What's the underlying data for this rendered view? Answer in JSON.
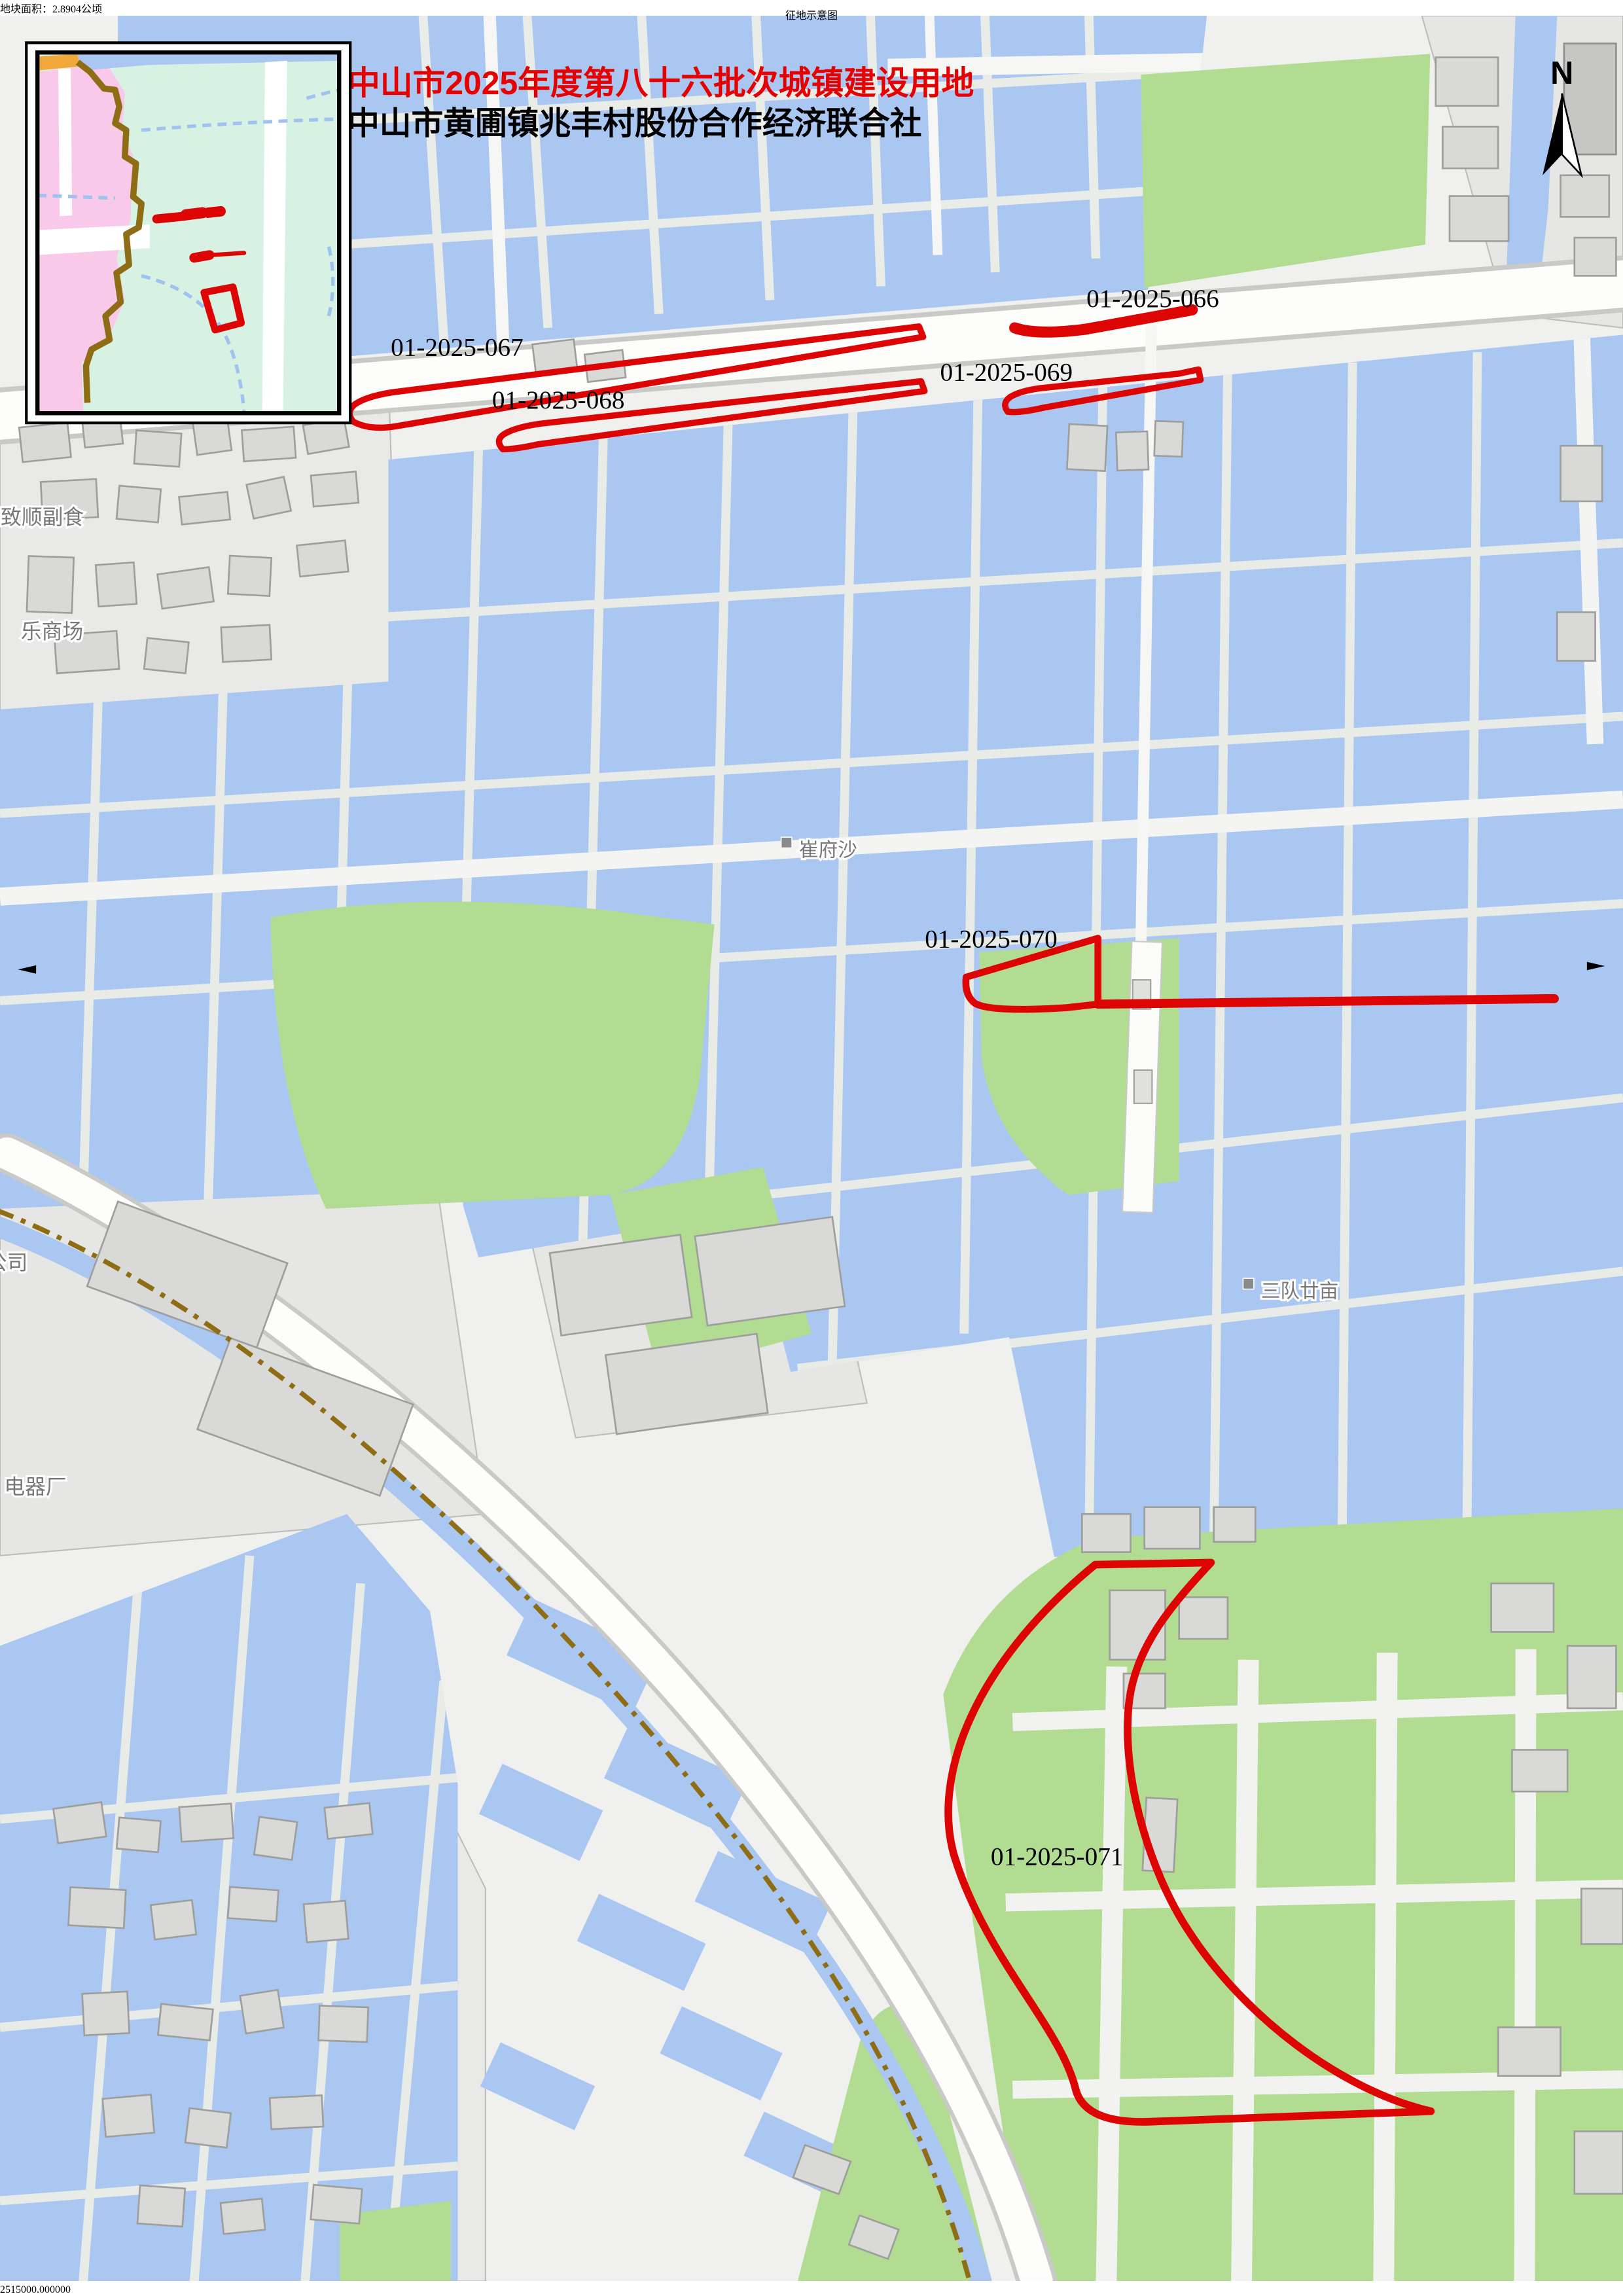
{
  "page": {
    "title": "征地示意图",
    "area_note": "地块面积：2.8904公顷",
    "footer_left": "制图单位：中山市自然资源局",
    "footer_right": "制图日期：2025年7月31日"
  },
  "map": {
    "batch_title": "中山市2025年度第八十六批次城镇建设用地",
    "org_name": "中山市黄圃镇兆丰村股份合作经济联合社",
    "north_label": "N",
    "coords": {
      "main": "2515000",
      "decimals": ".000000"
    },
    "parcel_labels": [
      "01-2025-066",
      "01-2025-067",
      "01-2025-068",
      "01-2025-069",
      "01-2025-070",
      "01-2025-071"
    ],
    "places": [
      "崔府沙",
      "三队廿亩",
      "致顺副食",
      "乐商场",
      "公司",
      "电器厂"
    ],
    "colors": {
      "parcel_outline": "#dd0404",
      "batch_title_red": "#e60000",
      "water": "#a9c7f1",
      "green": "#b2dc92",
      "inset_pink": "#f9c9e9",
      "inset_mint": "#d7f2e2",
      "boundary_brown": "#8f6d15"
    }
  }
}
